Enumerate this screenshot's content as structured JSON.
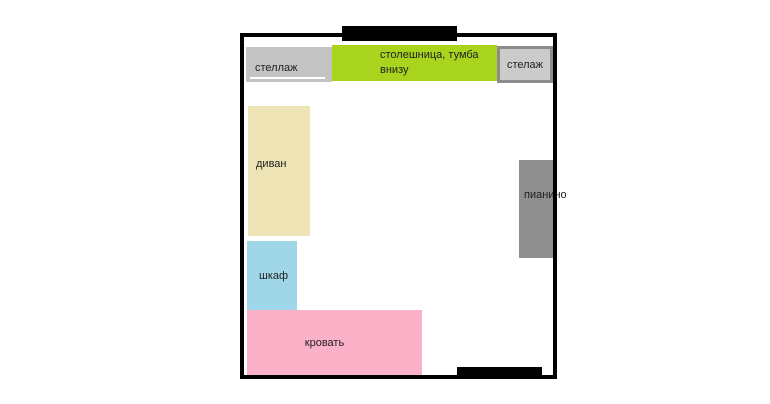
{
  "plan": {
    "background": "#ffffff",
    "wall_color": "#000000",
    "items": [
      {
        "id": "shelf-left",
        "label": "стеллаж",
        "color": "#c3c3c3"
      },
      {
        "id": "countertop",
        "label": "столешница, тумба внизу",
        "color": "#a9d41e"
      },
      {
        "id": "shelf-right",
        "label": "стелаж",
        "color": "#cbcbcb",
        "border_color": "#8c8c8c"
      },
      {
        "id": "sofa",
        "label": "диван",
        "color": "#eee3b4"
      },
      {
        "id": "wardrobe",
        "label": "шкаф",
        "color": "#9fd7e8"
      },
      {
        "id": "bed",
        "label": "кровать",
        "color": "#fbb1c7"
      },
      {
        "id": "piano",
        "label": "пианино",
        "color": "#8f8f8f"
      }
    ]
  }
}
